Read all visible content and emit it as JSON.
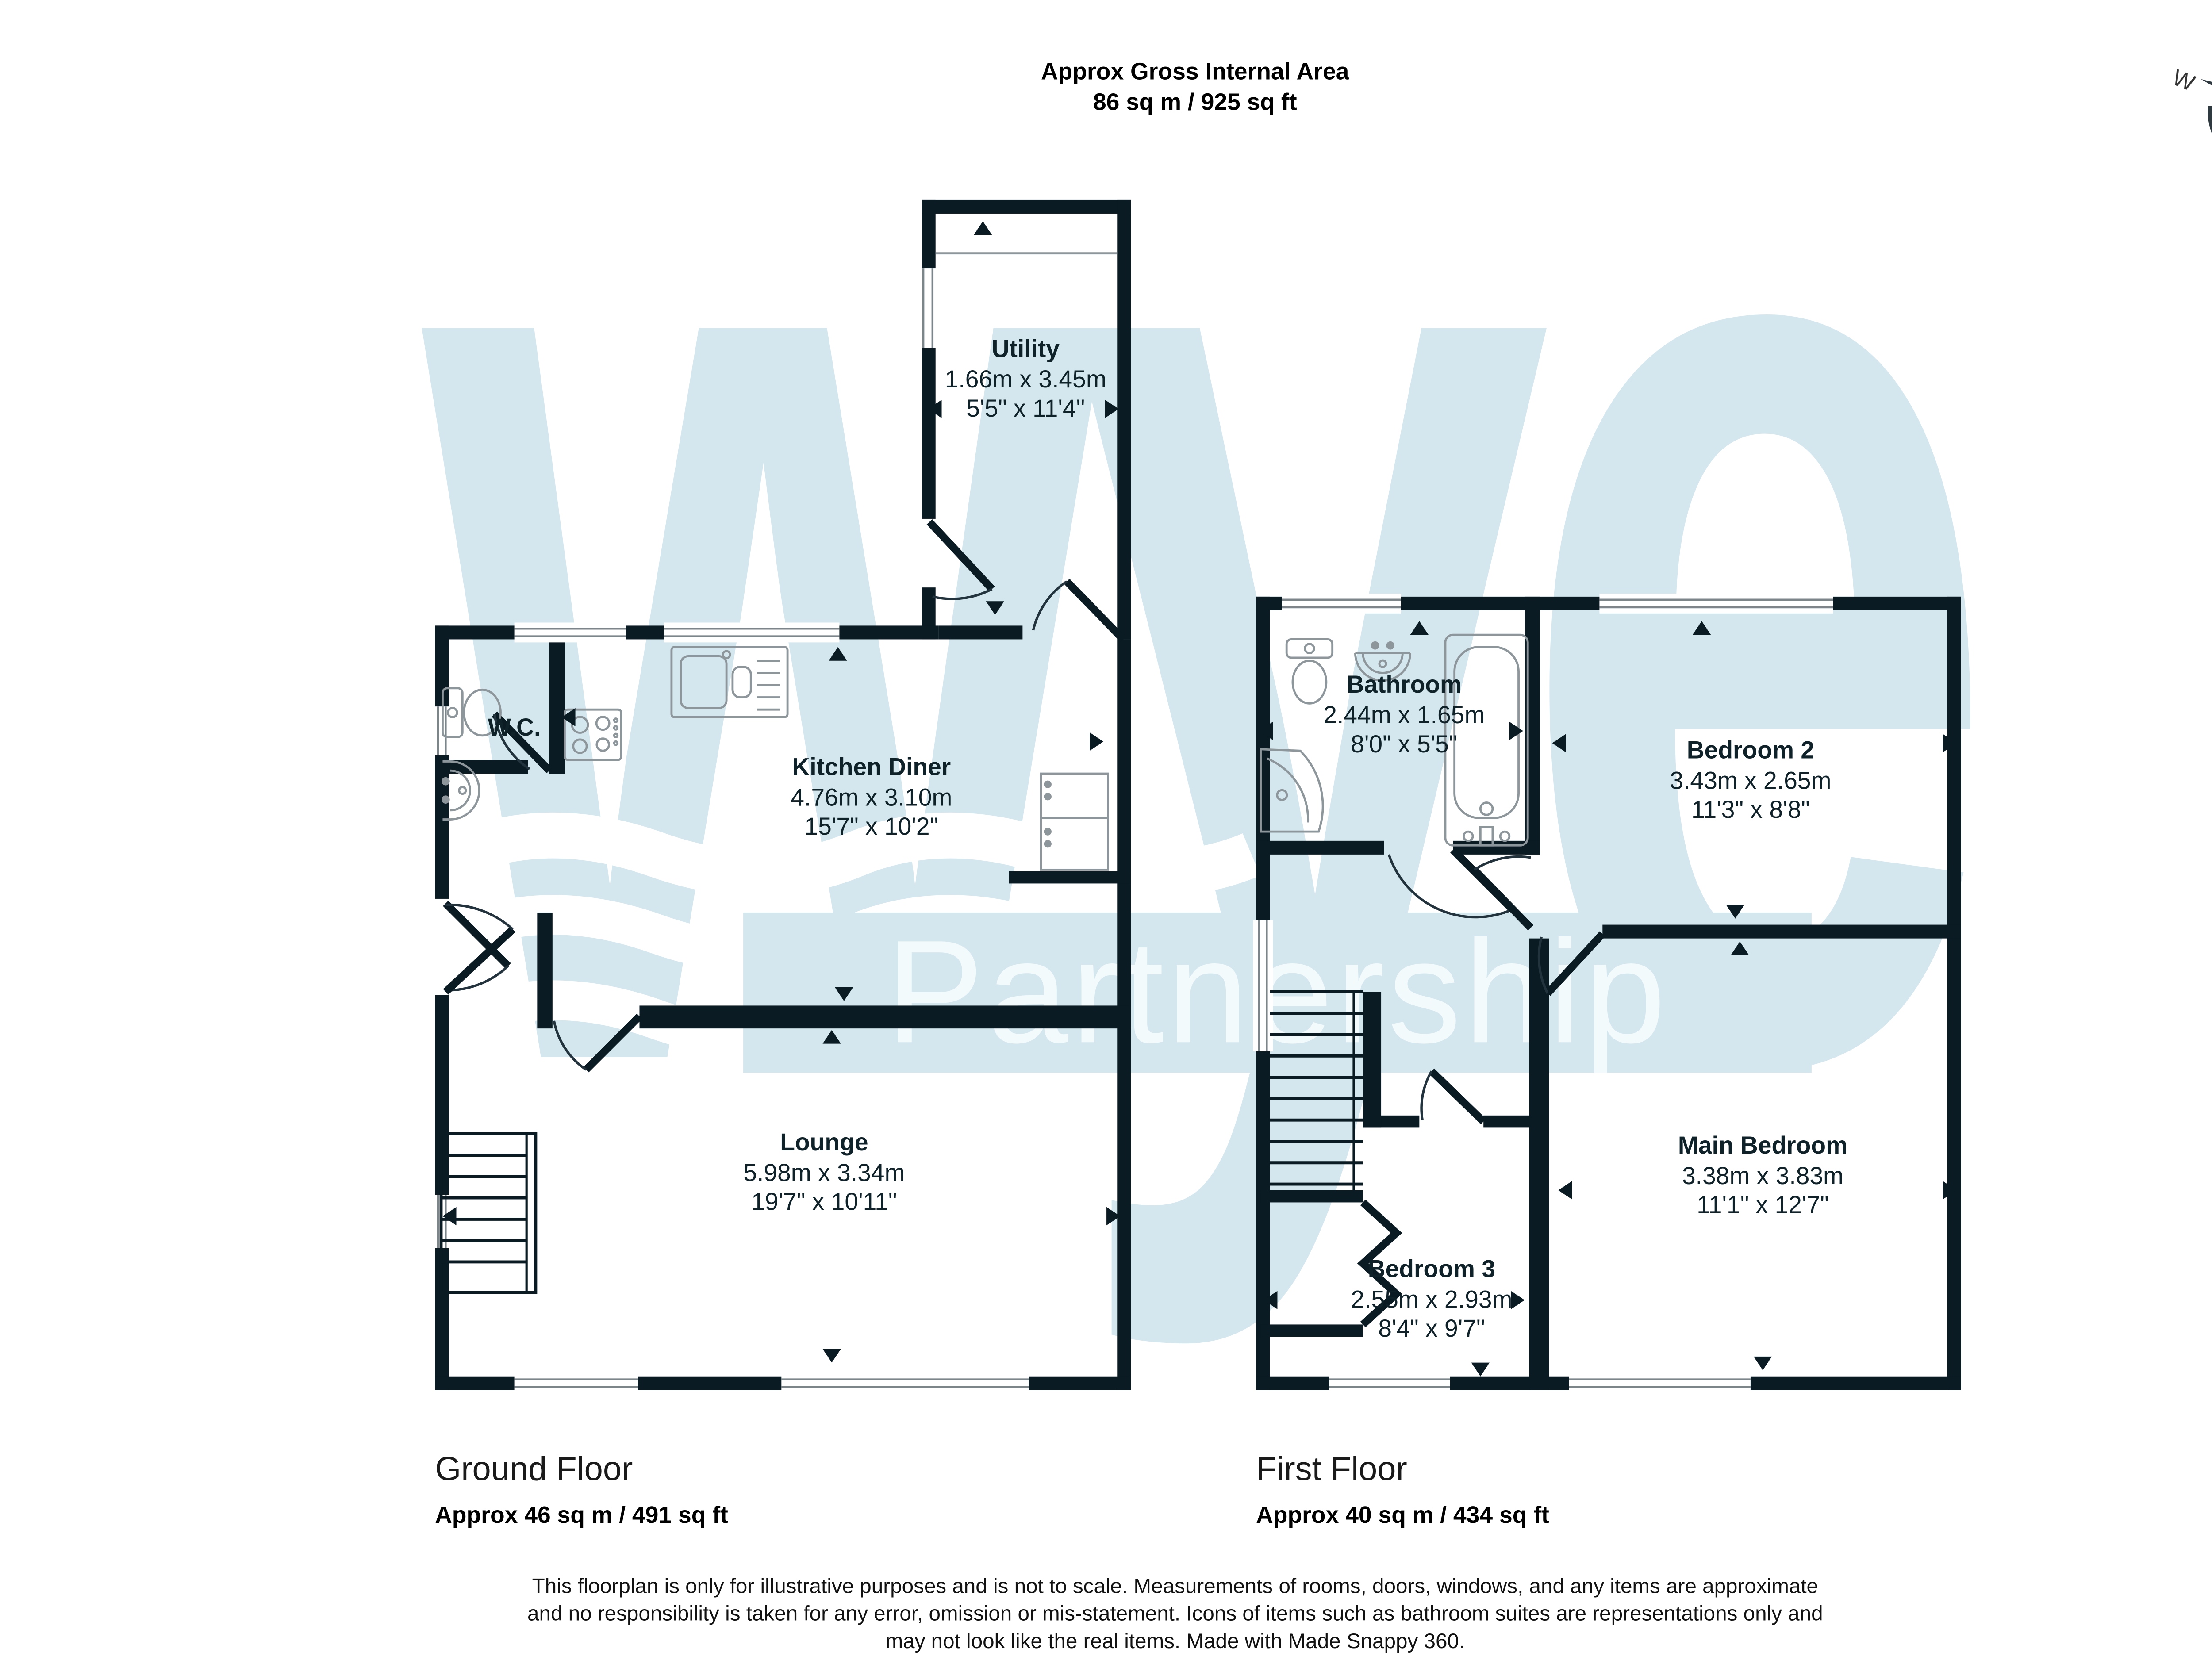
{
  "header": {
    "title_line1": "Approx Gross Internal Area",
    "title_line2": "86 sq m / 925 sq ft"
  },
  "compass": {
    "n": "N",
    "e": "E",
    "s": "S",
    "w": "W"
  },
  "watermark": {
    "word": "wye",
    "subword": "Partnership"
  },
  "ground_floor": {
    "label": "Ground Floor",
    "area": "Approx 46 sq m / 491 sq ft",
    "rooms": {
      "utility": {
        "name": "Utility",
        "dims_m": "1.66m x 3.45m",
        "dims_ft": "5'5\" x 11'4\""
      },
      "wc": {
        "name": "W.C."
      },
      "kitchen": {
        "name": "Kitchen Diner",
        "dims_m": "4.76m x 3.10m",
        "dims_ft": "15'7\" x 10'2\""
      },
      "lounge": {
        "name": "Lounge",
        "dims_m": "5.98m x 3.34m",
        "dims_ft": "19'7\" x 10'11\""
      }
    }
  },
  "first_floor": {
    "label": "First Floor",
    "area": "Approx 40 sq m / 434 sq ft",
    "rooms": {
      "bathroom": {
        "name": "Bathroom",
        "dims_m": "2.44m x 1.65m",
        "dims_ft": "8'0\" x 5'5\""
      },
      "bedroom2": {
        "name": "Bedroom 2",
        "dims_m": "3.43m x 2.65m",
        "dims_ft": "11'3\" x 8'8\""
      },
      "main_bedroom": {
        "name": "Main Bedroom",
        "dims_m": "3.38m x 3.83m",
        "dims_ft": "11'1\" x 12'7\""
      },
      "bedroom3": {
        "name": "Bedroom 3",
        "dims_m": "2.55m x 2.93m",
        "dims_ft": "8'4\" x 9'7\""
      }
    }
  },
  "footer": {
    "line1": "This floorplan is only for illustrative purposes and is not to scale. Measurements of rooms, doors, windows, and any items are approximate",
    "line2": "and no responsibility is taken for any error, omission or mis-statement. Icons of items such as bathroom suites are representations only and",
    "line3": "may not look like the real items. Made with Made Snappy 360."
  },
  "colors": {
    "wall": "#0b1b24",
    "watermark_blue": "#d5e7ee",
    "fixture_gray": "#8d969b"
  }
}
